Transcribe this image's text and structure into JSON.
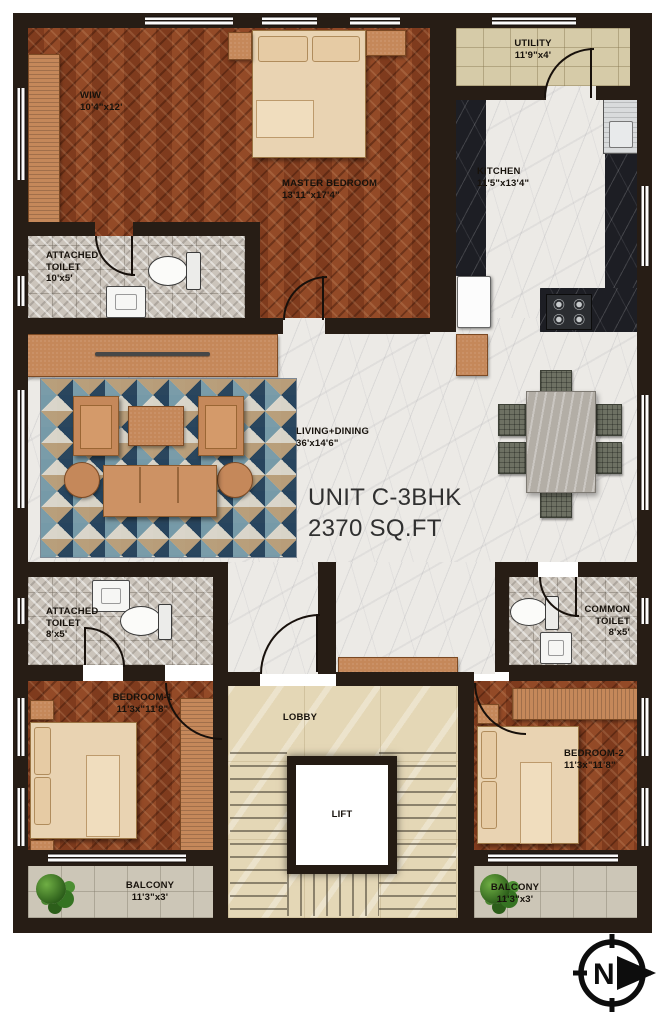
{
  "title": {
    "unit": "UNIT C-3BHK",
    "area": "2370 SQ.FT"
  },
  "rooms": {
    "wiw": {
      "name": "WIW",
      "dims": "10'4\"x12'"
    },
    "master_bedroom": {
      "name": "MASTER BEDROOM",
      "dims": "13'11\"x17'4\""
    },
    "utility": {
      "name": "UTILITY",
      "dims": "11'9\"x4'"
    },
    "kitchen": {
      "name": "KITCHEN",
      "dims": "11'5\"x13'4\""
    },
    "attached_toilet_1": {
      "name": "ATTACHED TOILET",
      "dims": "10'x5'"
    },
    "living_dining": {
      "name": "LIVING+DINING",
      "dims": "36'x14'6\""
    },
    "attached_toilet_2": {
      "name": "ATTACHED TOILET",
      "dims": "8'x5'"
    },
    "common_toilet": {
      "name": "COMMON TOILET",
      "dims": "8'x5'"
    },
    "bedroom_1": {
      "name": "BEDROOM-1",
      "dims": "11'3x\"11'8\""
    },
    "bedroom_2": {
      "name": "BEDROOM-2",
      "dims": "11'3x\"11'8\""
    },
    "lobby": {
      "name": "LOBBY"
    },
    "lift": {
      "name": "LIFT"
    },
    "balcony_1": {
      "name": "BALCONY",
      "dims": "11'3\"x3'"
    },
    "balcony_2": {
      "name": "BALCONY",
      "dims": "11'3\"x3'"
    }
  },
  "compass": {
    "label": "N"
  },
  "colors": {
    "wall": "#271d15",
    "wood": "#8a4425",
    "marble": "#eceae6",
    "lobby_marble": "#e4d7b6",
    "toilet_tile": "#cbc4bb",
    "utility_tile": "#d6cba8",
    "balcony_stone": "#ccc6b7",
    "counter_dark": "#1d1e24",
    "furniture_tan": "#c5885a",
    "bed_linen": "#e9d3b2",
    "rug_navy": "#2e4a63",
    "plant_green": "#3f7d2c"
  }
}
